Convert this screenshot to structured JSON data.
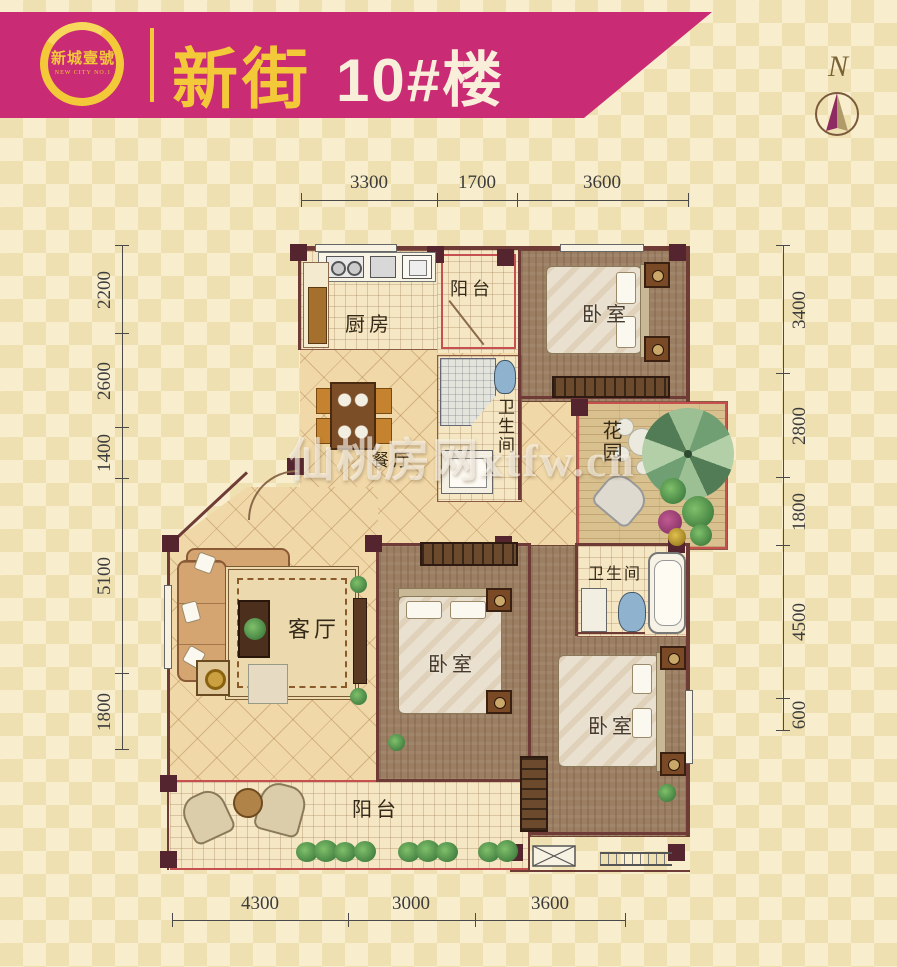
{
  "header": {
    "logo_name": "新城壹號",
    "logo_subtitle": "NEW CITY NO.1",
    "title_cn": "新街",
    "title_num": "10#楼"
  },
  "compass": {
    "label": "N"
  },
  "watermark": "仙桃房网xtfw.cn",
  "rooms": {
    "kitchen": "厨房",
    "balcony_top": "阳台",
    "bedroom_top": "卧室",
    "bath1": "卫生间",
    "dining": "餐厅",
    "garden": "花园",
    "living": "客厅",
    "bedroom_mid": "卧室",
    "bath2": "卫生间",
    "bedroom_bottom": "卧室",
    "balcony_bottom": "阳台"
  },
  "dimensions": {
    "top": [
      "3300",
      "1700",
      "3600"
    ],
    "bottom": [
      "4300",
      "3000",
      "3600"
    ],
    "left": [
      "2200",
      "2600",
      "1400",
      "5100",
      "1800"
    ],
    "right": [
      "3400",
      "2800",
      "1800",
      "4500",
      "600"
    ]
  },
  "colors": {
    "banner": "#c92b74",
    "gold": "#f3c93a",
    "wall": "#54252f",
    "red_accent": "#c65050",
    "background": "#f8eecd"
  }
}
